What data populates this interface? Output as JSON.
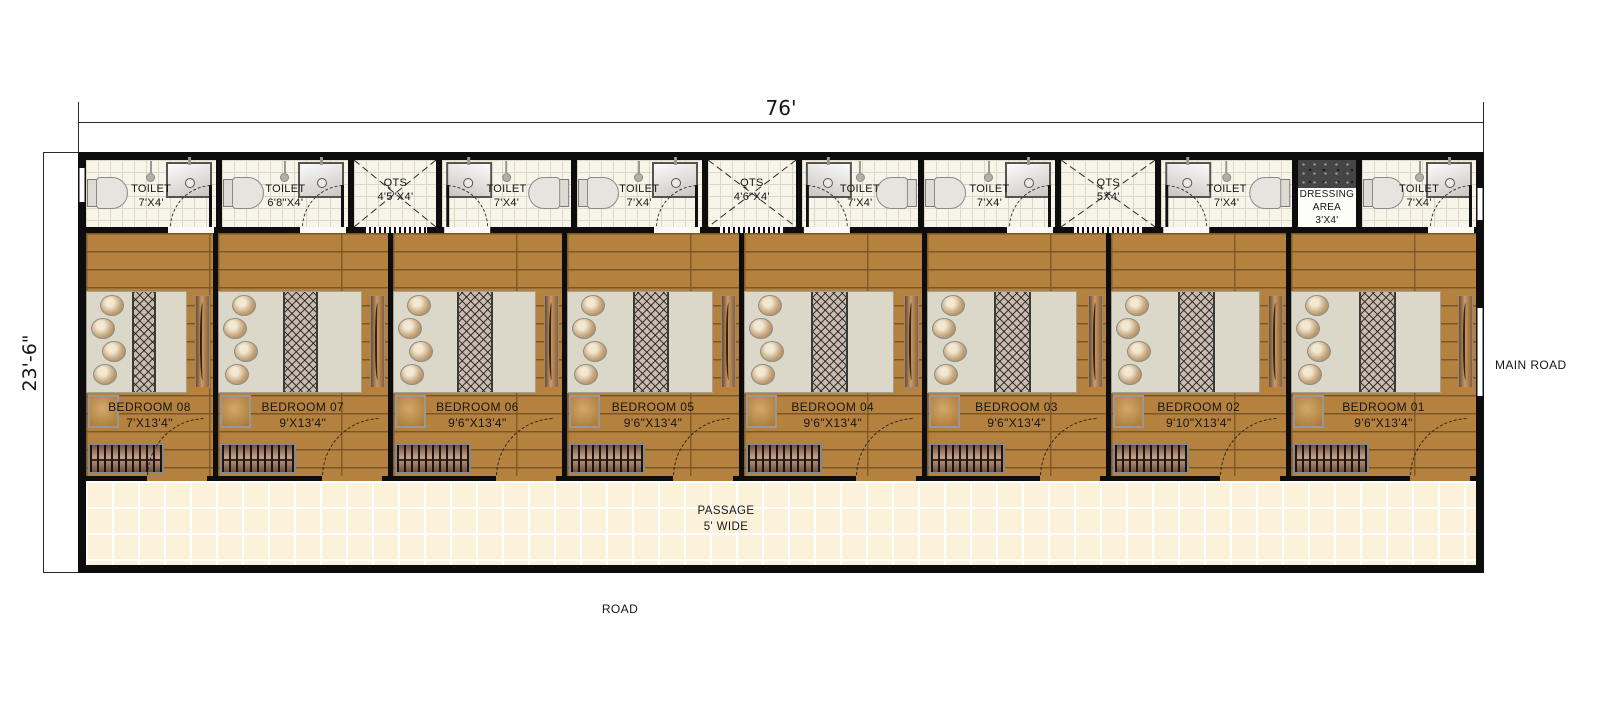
{
  "annotations": {
    "width_dim": "76'",
    "height_dim": "23'-6\"",
    "main_road": "MAIN ROAD",
    "road": "ROAD",
    "passage": {
      "line1": "PASSAGE",
      "line2": "5' WIDE"
    }
  },
  "top_row": [
    {
      "name": "TOILET",
      "size": "7'X4'"
    },
    {
      "name": "TOILET",
      "size": "6'8\"X4'"
    },
    {
      "name": "QTS",
      "size": "4'5\"X4'"
    },
    {
      "name": "TOILET",
      "size": "7'X4'"
    },
    {
      "name": "TOILET",
      "size": "7'X4'"
    },
    {
      "name": "QTS",
      "size": "4'6\"X4'"
    },
    {
      "name": "TOILET",
      "size": "7'X4'"
    },
    {
      "name": "TOILET",
      "size": "7'X4'"
    },
    {
      "name": "QTS",
      "size": "5X4'"
    },
    {
      "name": "TOILET",
      "size": "7'X4'"
    },
    {
      "name": "DRESSING AREA",
      "size": "3'X4'"
    },
    {
      "name": "TOILET",
      "size": "7'X4'"
    }
  ],
  "bedrooms": [
    {
      "name": "BEDROOM 08",
      "size": "7'X13'4\""
    },
    {
      "name": "BEDROOM 07",
      "size": "9'X13'4\""
    },
    {
      "name": "BEDROOM 06",
      "size": "9'6\"X13'4\""
    },
    {
      "name": "BEDROOM 05",
      "size": "9'6\"X13'4\""
    },
    {
      "name": "BEDROOM 04",
      "size": "9'6\"X13'4\""
    },
    {
      "name": "BEDROOM 03",
      "size": "9'6\"X13'4\""
    },
    {
      "name": "BEDROOM 02",
      "size": "9'10\"X13'4\""
    },
    {
      "name": "BEDROOM 01",
      "size": "9'6\"X13'4\""
    }
  ],
  "colors": {
    "wall": "#0d0d0d",
    "wood_floor": "#b5813f",
    "tile": "#f7f4ea",
    "passage_floor": "#fcf2d9",
    "bed": "#dbd8ca",
    "granite": "#454545"
  }
}
